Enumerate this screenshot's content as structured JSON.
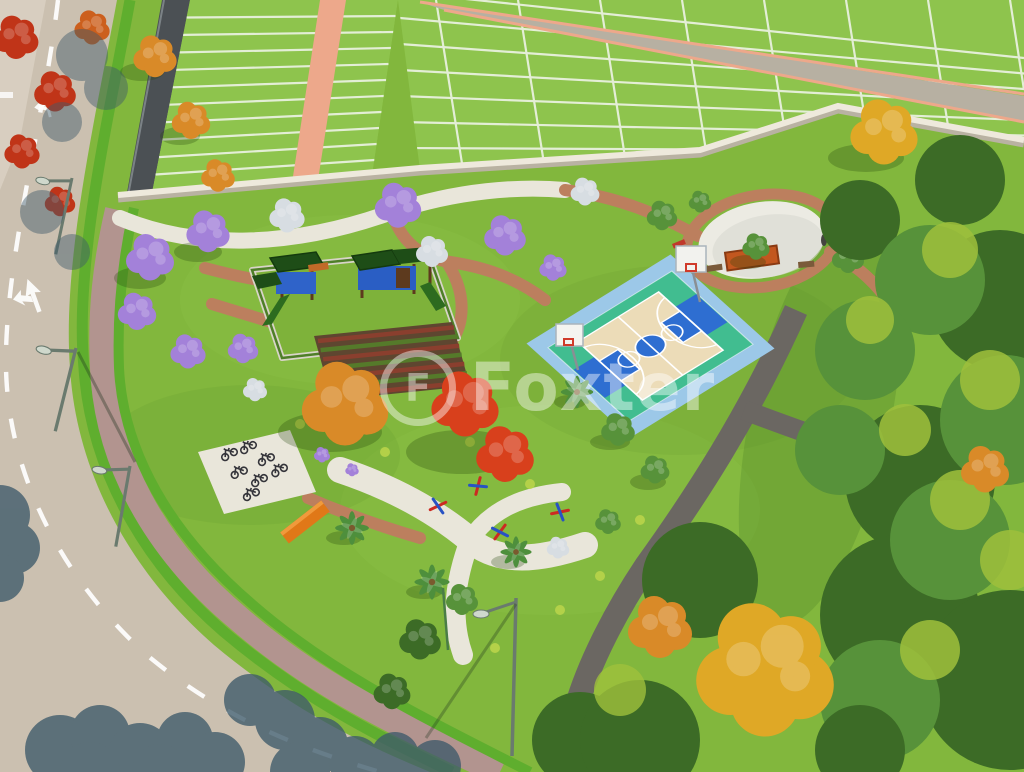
{
  "watermark": {
    "text": "Foxter",
    "logo_letter": "F"
  },
  "scene": {
    "type": "aerial-3d-render",
    "description": "Aerial 3D rendering of a residential land development: a landscaped park with playground, community garden, basketball court, round plaza, bike parking, outdoor gym and flowering trees, bordered by a perimeter wall, subdivided lots and a curved access road.",
    "elements": [
      "curved asphalt road with dashed center line and turn arrow markings",
      "paver sidewalk with green verges",
      "residential lots marked with white divider lines",
      "lot access road with salmon edges",
      "perimeter wall",
      "park promenade and brick paths",
      "jacaranda trees",
      "silver flowering trees",
      "autumn orange trees",
      "red flamboyant tree",
      "palm trees",
      "playground with slides",
      "community garden beds",
      "basketball court with hoops",
      "oval plaza with planter and benches",
      "bike parking pad with bicycles",
      "outdoor fitness equipment",
      "street lamps",
      "tree shadows on road"
    ]
  },
  "colors": {
    "grass-park": "#82b73d",
    "grass-lots": "#8ec44d",
    "grass-strip": "#5fae2e",
    "road": "#cbc0b0",
    "sidewalk": "#b2948f",
    "path-brick": "#bc7f5e",
    "path-concrete": "#e9e6da",
    "path-asphalt": "#6b6762",
    "wall-light": "#eee9dc",
    "wall-shadow": "#b9b2a2",
    "wall-dark": "#4b5054",
    "lot-line": "#f3f6ef",
    "lot-path": "#eda88b",
    "court-outer": "#9cc8e8",
    "court-green": "#41bd90",
    "court-tan": "#ecdcb8",
    "court-blue": "#2e6ed1",
    "tree-purple": "#a381d9",
    "tree-silver": "#d7dde2",
    "tree-orange": "#d98a28",
    "tree-gold": "#dfa826",
    "tree-red": "#c03418",
    "tree-red-bright": "#d8401c",
    "tree-green": "#57923a",
    "tree-green-dark": "#3c6b26",
    "tree-green-light": "#9fc03c",
    "palm-green": "#4e8f3c",
    "shadow-road": "#3e5a6a",
    "bench-orange": "#e07818",
    "equip-red": "#cc2a22",
    "equip-blue": "#2853c4"
  }
}
